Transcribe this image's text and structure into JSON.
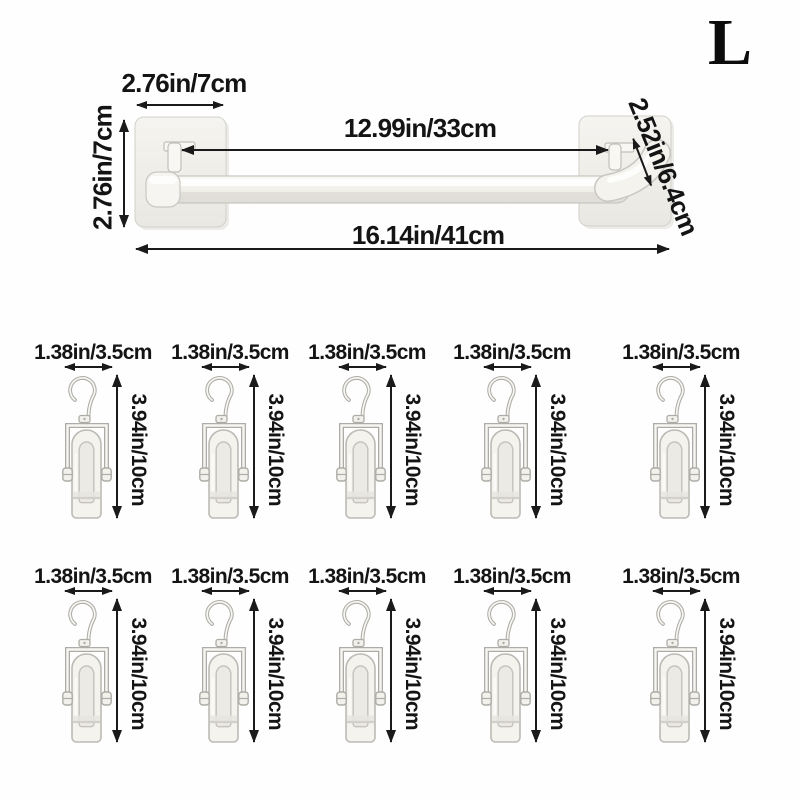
{
  "size_label": "L",
  "rack": {
    "plate_width_label": "2.76in/7cm",
    "plate_height_label": "2.76in/7cm",
    "rod_inner_length_label": "12.99in/33cm",
    "total_length_label": "16.14in/41cm",
    "bracket_depth_label": "2.52in/6.4cm"
  },
  "hanger": {
    "width_label": "1.38in/3.5cm",
    "height_label": "3.94in/10cm",
    "count": 10,
    "rows": 2,
    "per_row": 5
  },
  "colors": {
    "background": "#fefefe",
    "text": "#141414",
    "arrow": "#1a1a1a",
    "product_fill": "#f4f3ee",
    "product_outline": "#aeaca6"
  }
}
